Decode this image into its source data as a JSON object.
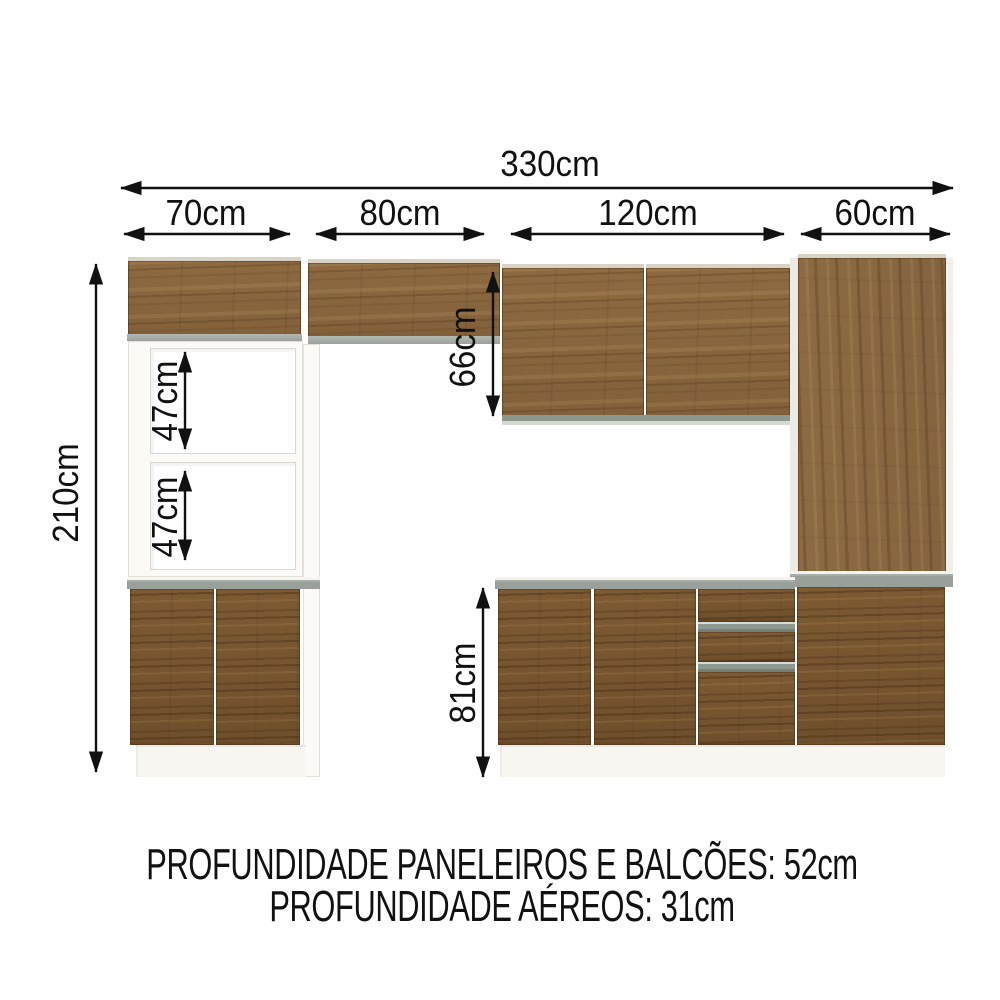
{
  "diagram": {
    "type": "kitchen-cabinet-dimension-diagram",
    "dimensions": {
      "total_width": {
        "label": "330cm"
      },
      "sections": [
        {
          "id": "oven-tower",
          "label": "70cm"
        },
        {
          "id": "bridge-cabinet",
          "label": "80cm"
        },
        {
          "id": "wall-cabinet",
          "label": "120cm"
        },
        {
          "id": "tall-cabinet",
          "label": "60cm"
        }
      ],
      "total_height": {
        "label": "210cm"
      },
      "niche_upper": {
        "label": "47cm"
      },
      "niche_lower": {
        "label": "47cm"
      },
      "wall_cabinet_height": {
        "label": "66cm"
      },
      "base_cabinet_height": {
        "label": "81cm"
      }
    },
    "notes": {
      "line1": "PROFUNDIDADE PANELEIROS E BALCÕES: 52cm",
      "line2": "PROFUNDIDADE AÉREOS: 31cm"
    },
    "colors": {
      "wood_upper": "#8a6740",
      "wood_lower": "#7a5833",
      "wood_tall": "#8c6a44",
      "counter_gray": "#99a099",
      "edge_gray": "#a9aeaa",
      "frame_white": "#fbfaf7",
      "arrow_black": "#111111",
      "background": "#ffffff"
    }
  }
}
